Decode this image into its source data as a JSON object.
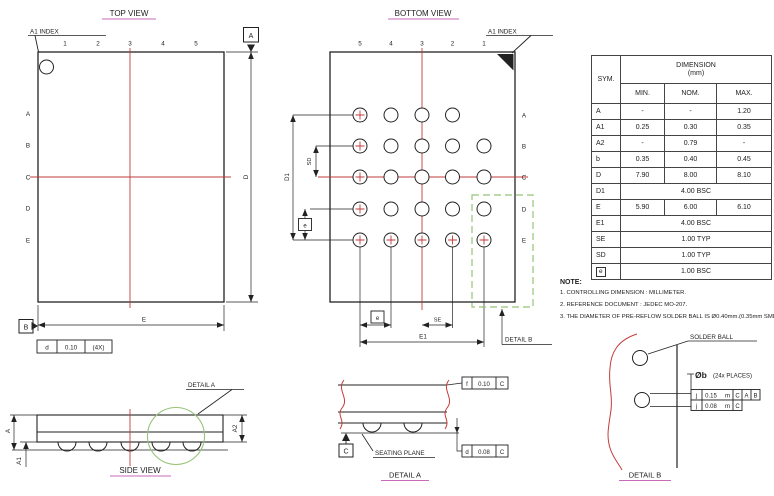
{
  "colors": {
    "line": "#222222",
    "red": "#c23b3b",
    "green": "#96c379",
    "magenta": "#b83aa0"
  },
  "top_view": {
    "title": "TOP VIEW",
    "a1_index": "A1 INDEX",
    "cols": [
      "1",
      "2",
      "3",
      "4",
      "5"
    ],
    "rows": [
      "A",
      "B",
      "C",
      "D",
      "E"
    ],
    "datum_a": "A",
    "datum_b": "B",
    "dim_d": "D",
    "dim_e": "E",
    "fcf": {
      "sym": "d",
      "tol": "0.10",
      "qty": "(4X)"
    }
  },
  "bottom_view": {
    "title": "BOTTOM VIEW",
    "a1_index": "A1 INDEX",
    "cols": [
      "5",
      "4",
      "3",
      "2",
      "1"
    ],
    "rows": [
      "A",
      "B",
      "C",
      "D",
      "E"
    ],
    "dim_d1": "D1",
    "dim_sd": "SD",
    "dim_e1": "E1",
    "dim_se": "SE",
    "pitch_left": "e",
    "pitch_bottom": "e",
    "detail_b_callout": "DETAIL B"
  },
  "side_view": {
    "title": "SIDE VIEW",
    "detail_a_callout": "DETAIL A",
    "dim_a": "A",
    "dim_a1": "A1",
    "dim_a2": "A2"
  },
  "detail_a": {
    "title": "DETAIL A",
    "seating_plane": "SEATING PLANE",
    "datum_c": "C",
    "fcf_top": {
      "sym": "f",
      "tol": "0.10",
      "datum": "C"
    },
    "fcf_bottom": {
      "sym": "d",
      "tol": "0.08",
      "datum": "C"
    }
  },
  "detail_b": {
    "title": "DETAIL B",
    "solder_ball": "SOLDER BALL",
    "ball_dia": "Øb",
    "places": "(24x PLACES)",
    "fcf_rows": [
      {
        "sym": "j",
        "tol": "0.15",
        "mod": "m",
        "d1": "C",
        "d2": "A",
        "d3": "B"
      },
      {
        "sym": "j",
        "tol": "0.08",
        "mod": "m",
        "d1": "C"
      }
    ]
  },
  "table": {
    "sym_header": "SYM.",
    "dim_header": "DIMENSION",
    "dim_unit": "(mm)",
    "col_headers": [
      "MIN.",
      "NOM.",
      "MAX."
    ],
    "rows": [
      {
        "sym": "A",
        "min": "-",
        "nom": "-",
        "max": "1.20"
      },
      {
        "sym": "A1",
        "min": "0.25",
        "nom": "0.30",
        "max": "0.35"
      },
      {
        "sym": "A2",
        "min": "-",
        "nom": "0.79",
        "max": "-"
      },
      {
        "sym": "b",
        "min": "0.35",
        "nom": "0.40",
        "max": "0.45"
      },
      {
        "sym": "D",
        "min": "7.90",
        "nom": "8.00",
        "max": "8.10"
      },
      {
        "sym": "D1",
        "span": "4.00 BSC"
      },
      {
        "sym": "E",
        "min": "5.90",
        "nom": "6.00",
        "max": "6.10"
      },
      {
        "sym": "E1",
        "span": "4.00 BSC"
      },
      {
        "sym": "SE",
        "span": "1.00 TYP"
      },
      {
        "sym": "SD",
        "span": "1.00 TYP"
      },
      {
        "sym": "e",
        "span": "1.00 BSC"
      }
    ]
  },
  "notes": {
    "heading": "NOTE:",
    "items": [
      "1. CONTROLLING DIMENSION : MILLIMETER.",
      "2. REFERENCE DOCUMENT : JEDEC MO-207.",
      "3. THE DIAMETER OF PRE-REFLOW SOLDER BALL IS Ø0.40mm.(0.35mm SMD)"
    ]
  }
}
